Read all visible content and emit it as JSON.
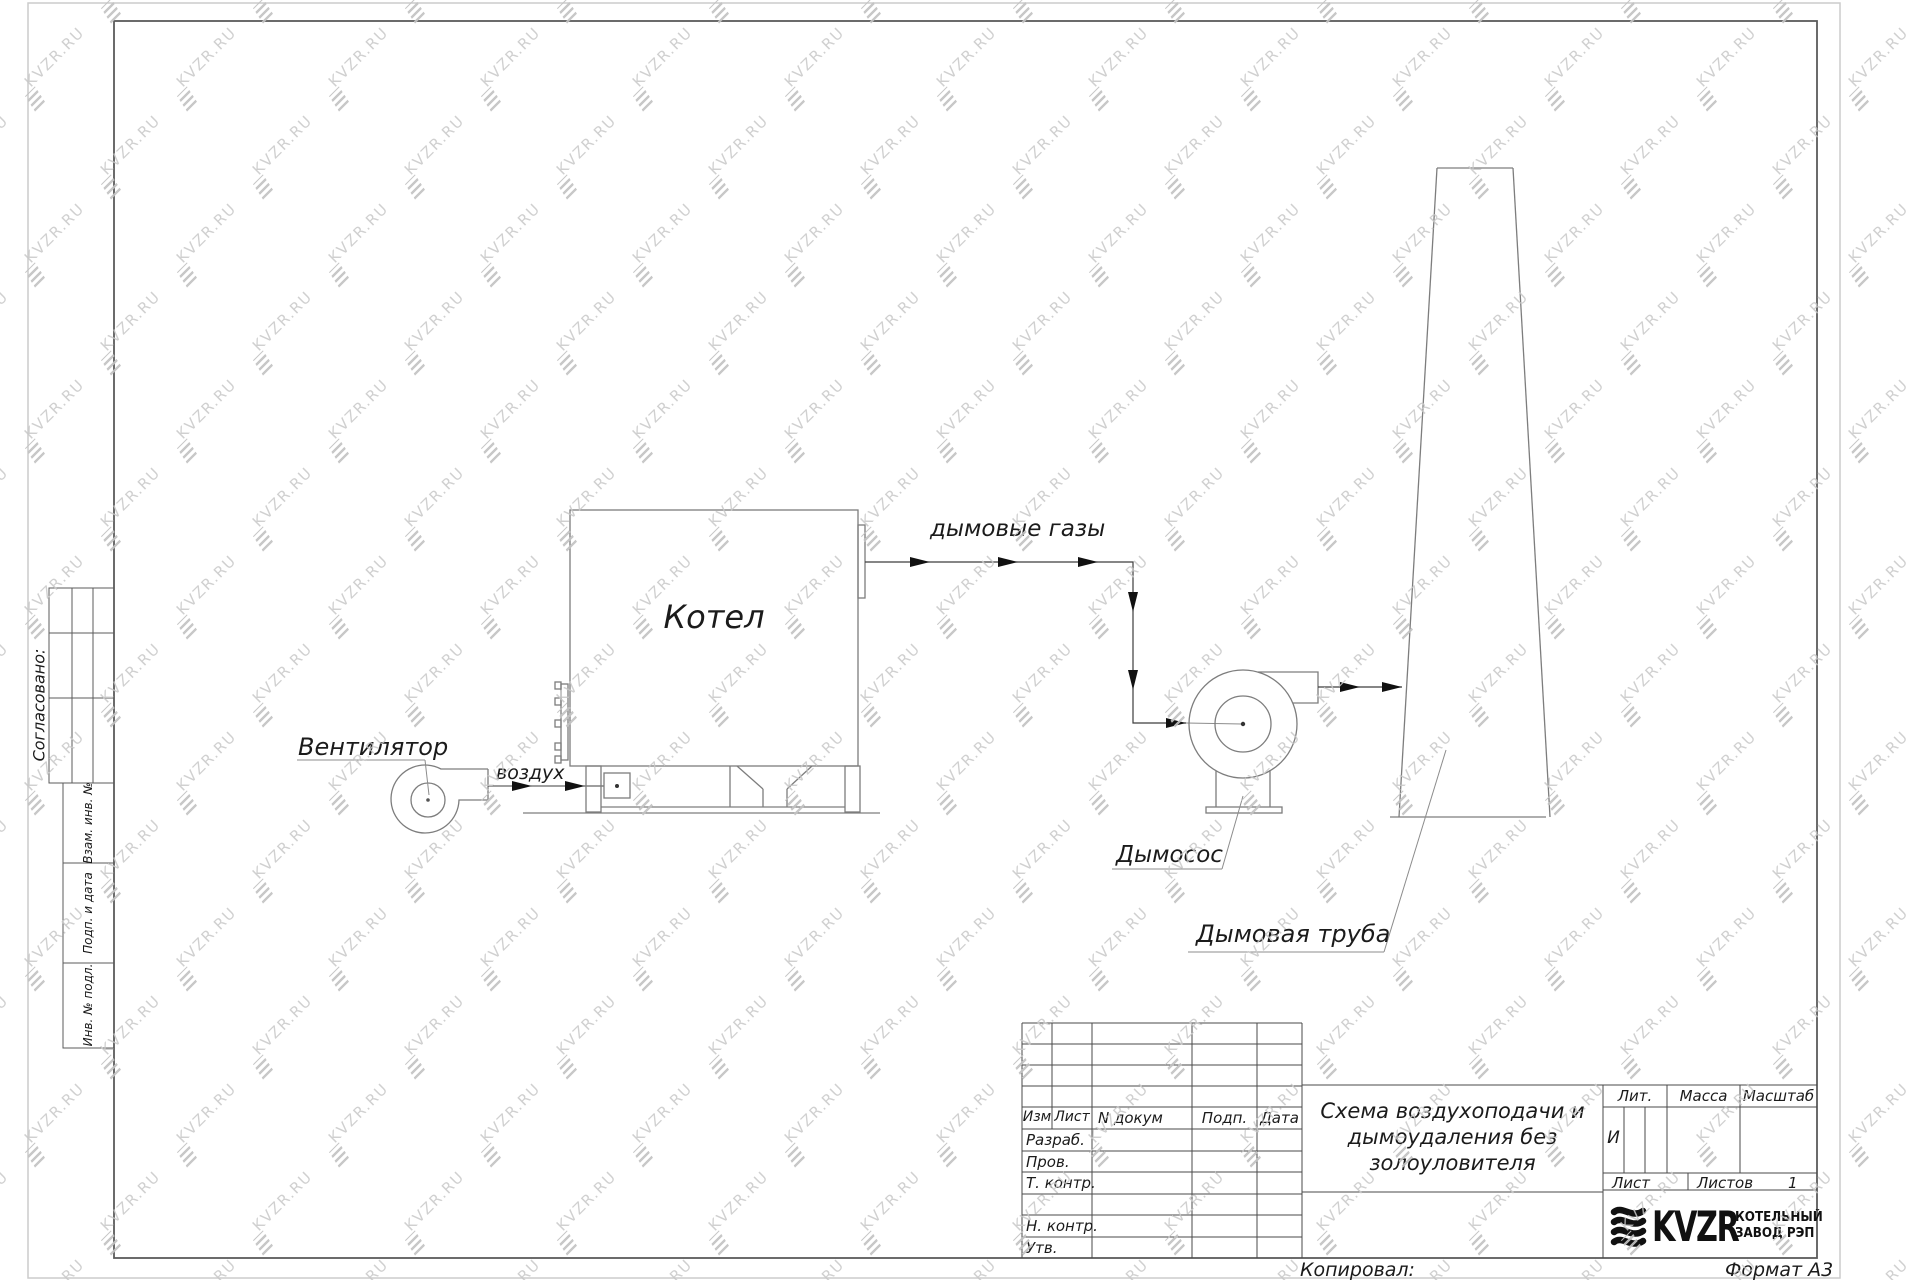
{
  "watermark": {
    "text": "KVZR.RU"
  },
  "page": {
    "copied_label": "Копировал:",
    "format_label": "Формат А3"
  },
  "sidebar": {
    "approved_label": "Согласовано:",
    "box_labels": [
      "Взам. инв. №",
      "Подп. и дата",
      "Инв. № подл."
    ]
  },
  "diagram": {
    "fan_label": "Вентилятор",
    "air_label": "воздух",
    "boiler_label": "Котел",
    "flue_gases_label": "дымовые газы",
    "smoke_exhauster_label": "Дымосос",
    "chimney_label": "Дымовая труба"
  },
  "title_block": {
    "columns": {
      "izm": "Изм",
      "list": "Лист",
      "doc": "N докум",
      "sign": "Подп.",
      "date": "Дата"
    },
    "roles": [
      "Разраб.",
      "Пров.",
      "Т. контр.",
      "Н. контр.",
      "Утв."
    ],
    "title_lines": [
      "Схема воздухоподачи и",
      "дымоудаления без",
      "золоуловителя"
    ],
    "lit_label": "Лит.",
    "lit_value": "И",
    "mass_label": "Масса",
    "scale_label": "Масштаб",
    "sheet_label": "Лист",
    "sheets_label": "Листов",
    "sheets_value": "1",
    "logo": {
      "text": "KVZR",
      "line1": "КОТЕЛЬНЫЙ",
      "line2": "ЗАВОД РЭП"
    }
  },
  "colors": {
    "equipment_line": "#7d7d7d",
    "duct_line": "#3d3d3d",
    "frame_line": "#5b5b5b",
    "outer_border": "#cccccc",
    "watermark": "#c8c8c8",
    "text": "#1b1b1b"
  }
}
